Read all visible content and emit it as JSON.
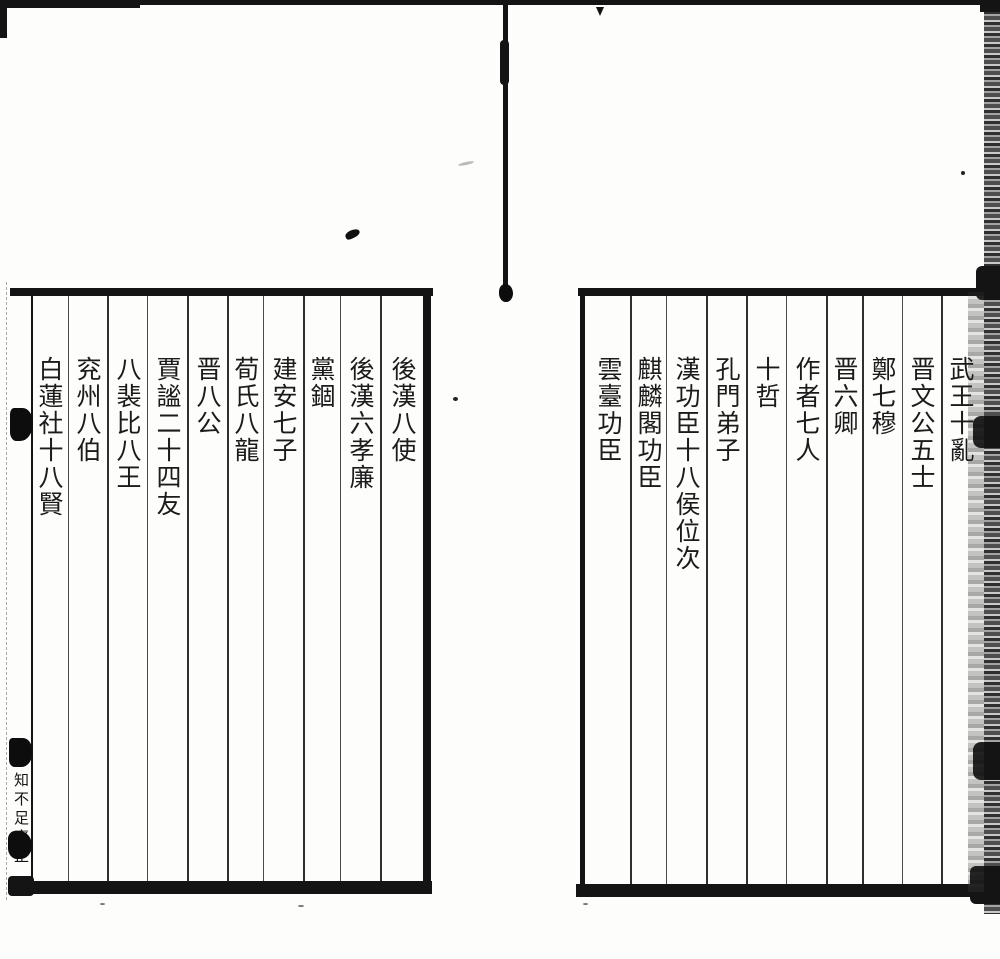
{
  "colors": {
    "ink": "#1b1b1b",
    "paper": "#fdfdfb",
    "frame_line": "#141414",
    "column_rule": "#2f2f2f"
  },
  "right_page": {
    "columns": [
      "武王十亂",
      "晋文公五士",
      "鄭七穆",
      "晋六卿",
      "作者七人",
      "十哲",
      "孔門弟子",
      "漢功臣十八侯位次",
      "麒麟閣功臣",
      "雲臺功臣"
    ]
  },
  "left_page": {
    "columns": [
      "後漢八使",
      "後漢六孝廉",
      "黨錮",
      "建安七子",
      "荀氏八龍",
      "晋八公",
      "賈謐二十四友",
      "八裴比八王",
      "兖州八伯",
      "白蓮社十八賢"
    ]
  },
  "colophon": {
    "text": "知不足齋正"
  }
}
